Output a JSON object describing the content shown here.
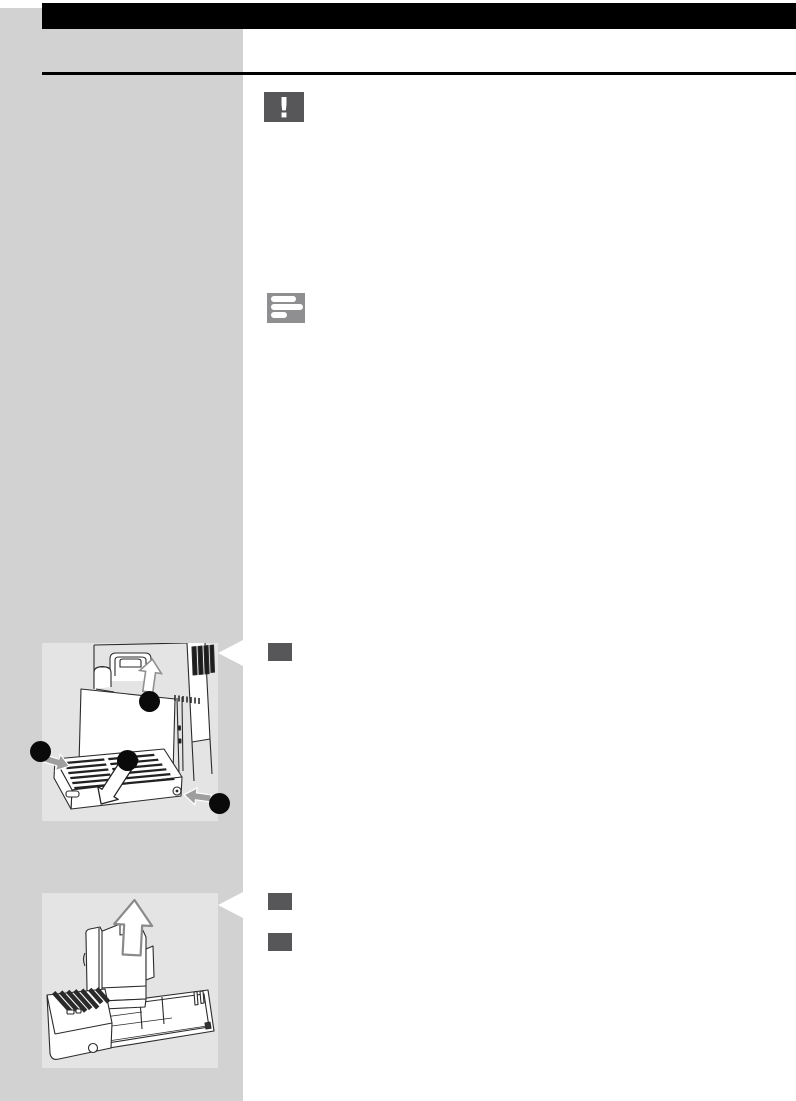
{
  "page": {
    "kind": "user-manual-instruction-page",
    "visible_text": ""
  },
  "colors": {
    "header_bar": "#000000",
    "heading_rule": "#000000",
    "sidebar": "#d2d2d2",
    "figure_background": "#e4e4e4",
    "step_marker": "#57575a",
    "warning_icon_bg": "#57575a",
    "note_icon_bg": "#8f8f91",
    "callout_dot": "#0a0a0a",
    "arrow_gray": "#9e9e9e",
    "line_art": "#2b2b2b",
    "pointer": "#ffffff"
  },
  "icons": {
    "warning": {
      "name": "warning-exclamation-icon",
      "glyph": "!"
    },
    "note": {
      "name": "note-text-lines-icon"
    }
  },
  "figures": [
    {
      "name": "machine-front-drip-tray-illustration",
      "callout_dots": 4,
      "arrows": [
        "up-arrow",
        "gray-arrow-into-tray-left",
        "gray-arrow-into-release-button",
        "white-pull-out-arrow"
      ],
      "pointer": "white-triangle-to-step"
    },
    {
      "name": "drip-tray-grounds-container-removal-illustration",
      "callout_dots": 0,
      "arrows": [
        "up-arrow"
      ],
      "pointer": "white-triangle-to-step"
    }
  ],
  "steps": [
    {
      "name": "step-marker-1"
    },
    {
      "name": "step-marker-2"
    },
    {
      "name": "step-marker-3"
    }
  ]
}
